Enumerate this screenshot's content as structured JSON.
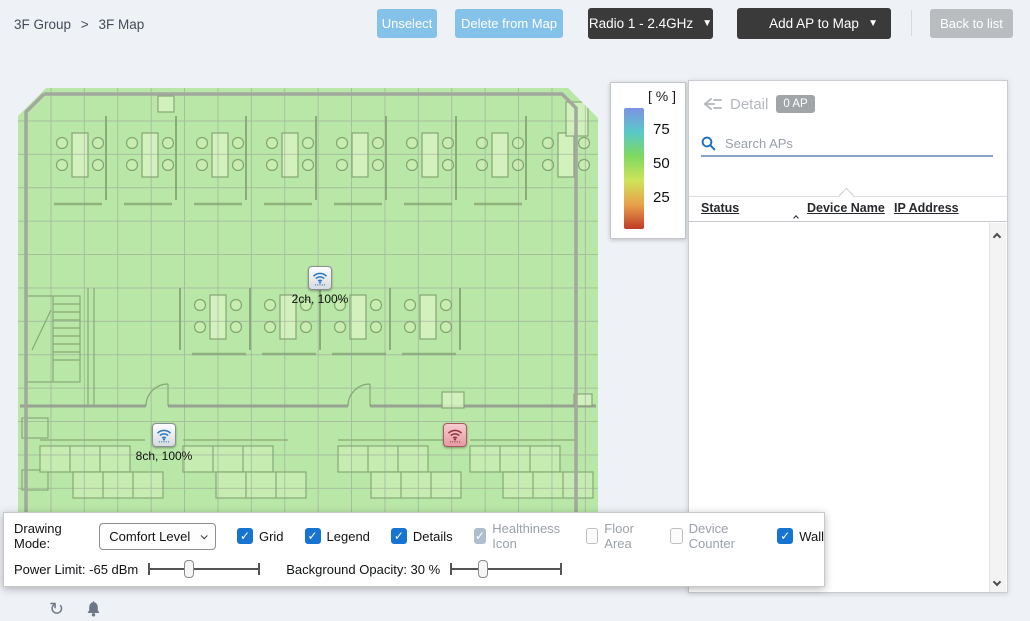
{
  "breadcrumb": {
    "group": "3F Group",
    "separator": ">",
    "current": "3F Map"
  },
  "header_buttons": {
    "unselect": "Unselect",
    "delete_from_map": "Delete from Map",
    "radio_selector": "Radio 1 - 2.4GHz",
    "add_ap_to_map": "Add AP to Map",
    "back_to_list": "Back to list"
  },
  "legend": {
    "title": "[ % ]",
    "ticks": [
      "75",
      "50",
      "25"
    ],
    "gradient_colors": [
      "#7d92e3",
      "#58c9c9",
      "#7fd95f",
      "#cfe35a",
      "#e8a04a",
      "#bf3c28"
    ]
  },
  "map": {
    "aps": [
      {
        "id": "ap-2ch",
        "label": "2ch, 100%",
        "x": 302,
        "y": 190,
        "status": "normal"
      },
      {
        "id": "ap-8ch",
        "label": "8ch, 100%",
        "x": 146,
        "y": 347,
        "status": "normal"
      },
      {
        "id": "ap-alert",
        "label": "",
        "x": 437,
        "y": 347,
        "status": "alert"
      }
    ]
  },
  "detail_panel": {
    "title": "Detail",
    "ap_count": "0 AP",
    "search_placeholder": "Search APs",
    "columns": [
      "Status",
      "Device Name",
      "IP Address"
    ],
    "sorted_column": "Device Name"
  },
  "drawing_toolbar": {
    "mode_label": "Drawing Mode:",
    "mode_value": "Comfort Level",
    "checkboxes": [
      {
        "label": "Grid",
        "checked": true,
        "disabled": false
      },
      {
        "label": "Legend",
        "checked": true,
        "disabled": false
      },
      {
        "label": "Details",
        "checked": true,
        "disabled": false
      },
      {
        "label": "Healthiness Icon",
        "checked": true,
        "disabled": true
      },
      {
        "label": "Floor Area",
        "checked": false,
        "disabled": true
      },
      {
        "label": "Device Counter",
        "checked": false,
        "disabled": true
      },
      {
        "label": "Wall",
        "checked": true,
        "disabled": false
      }
    ],
    "power_limit": {
      "label": "Power Limit: -65 dBm",
      "percent": 36
    },
    "background_opacity": {
      "label": "Background Opacity: 30 %",
      "percent": 29
    }
  },
  "icons": {
    "caret_down": "▼",
    "check": "✓",
    "refresh": "↻"
  },
  "colors": {
    "light_blue_button": "#85c2ea",
    "dark_button": "#3a3a3a",
    "gray_button": "#b9bdc0",
    "checkbox_blue": "#1774d1",
    "map_overlay_green": "#b9e7a7",
    "alert_ap": "#e89aa2"
  }
}
